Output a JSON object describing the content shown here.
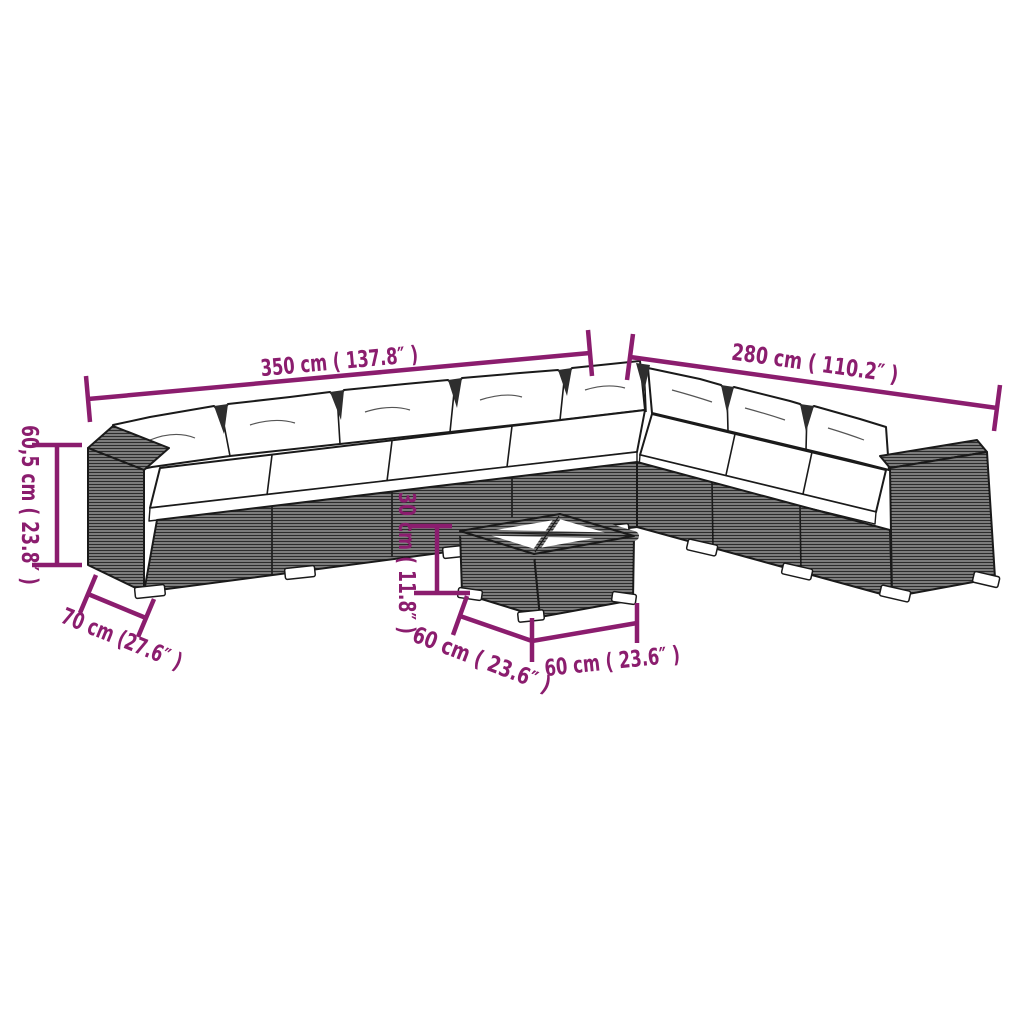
{
  "diagram": {
    "type": "furniture-dimension-diagram",
    "subject": "corner garden lounge set with coffee table"
  },
  "dimensions": {
    "sofa_length_left": "350 cm ( 137.8″ )",
    "sofa_length_right": "280 cm ( 110.2″ )",
    "sofa_height": "60,5 cm ( 23.8″ )",
    "sofa_depth": "70 cm (27.6″ )",
    "table_height": "30 cm ( 11.8″ )",
    "table_depth": "60 cm ( 23.6″ )",
    "table_width": "60 cm ( 23.6″ )"
  },
  "colors": {
    "accent": "#8b1d6e",
    "line": "#1a1a1a",
    "cushion": "#ffffff",
    "background": "#ffffff"
  }
}
